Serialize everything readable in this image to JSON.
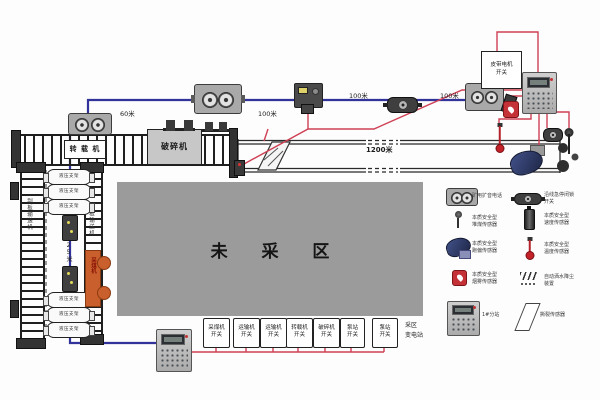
{
  "colors": {
    "cable_blue": "#31339b",
    "cable_red": "#cf4055",
    "unmined_gray": "#9b9b9b",
    "shearer_orange": "#c95f2d"
  },
  "top": {
    "transfer_label": "转 载 机",
    "crusher_label": "破碎机",
    "dist_60": "60米",
    "dist_100_a": "100米",
    "dist_100_b": "100米",
    "dist_100_c": "100米",
    "dist_1200": "1200米",
    "motor_switch_box": {
      "line1": "皮带电机",
      "line2": "开关"
    }
  },
  "face": {
    "afc_left_label": "刮板输送机",
    "afc_right_label": "刮板输送机",
    "support_label": "液压支架",
    "dist_25": "25米",
    "shearer_label": "采煤机"
  },
  "unmined_area_label": "未 采 区",
  "bottom": {
    "switches": [
      {
        "line1": "采煤机",
        "line2": "开关"
      },
      {
        "line1": "运输机",
        "line2": "开关"
      },
      {
        "line1": "运输机",
        "line2": "开关"
      },
      {
        "line1": "转载机",
        "line2": "开关"
      },
      {
        "line1": "破碎机",
        "line2": "开关"
      },
      {
        "line1": "泵站",
        "line2": "开关"
      },
      {
        "line1": "泵站",
        "line2": "开关"
      }
    ],
    "substation_note": {
      "line1": "采区",
      "line2": "变电站"
    }
  },
  "legend": {
    "items": [
      {
        "name": "voice-phone",
        "label1": "矿用扩音电话",
        "label2": ""
      },
      {
        "name": "emergency-stop-switch",
        "label1": "沿线急停闭锁",
        "label2": "开关"
      },
      {
        "name": "coal-pile-sensor",
        "label1": "本质安全型",
        "label2": "堆煤传感器"
      },
      {
        "name": "speed-sensor",
        "label1": "本质安全型",
        "label2": "速度传感器"
      },
      {
        "name": "deviation-sensor",
        "label1": "本质安全型",
        "label2": "跑偏传感器"
      },
      {
        "name": "temperature-sensor",
        "label1": "本质安全型",
        "label2": "温度传感器"
      },
      {
        "name": "smoke-sensor",
        "label1": "本质安全型",
        "label2": "烟雾传感器"
      },
      {
        "name": "sprinkler-device",
        "label1": "自动洒水降尘",
        "label2": "装置"
      },
      {
        "name": "substation",
        "label1": "1#分站",
        "label2": ""
      },
      {
        "name": "tear-sensor",
        "label1": "撕裂传感器",
        "label2": ""
      }
    ]
  }
}
